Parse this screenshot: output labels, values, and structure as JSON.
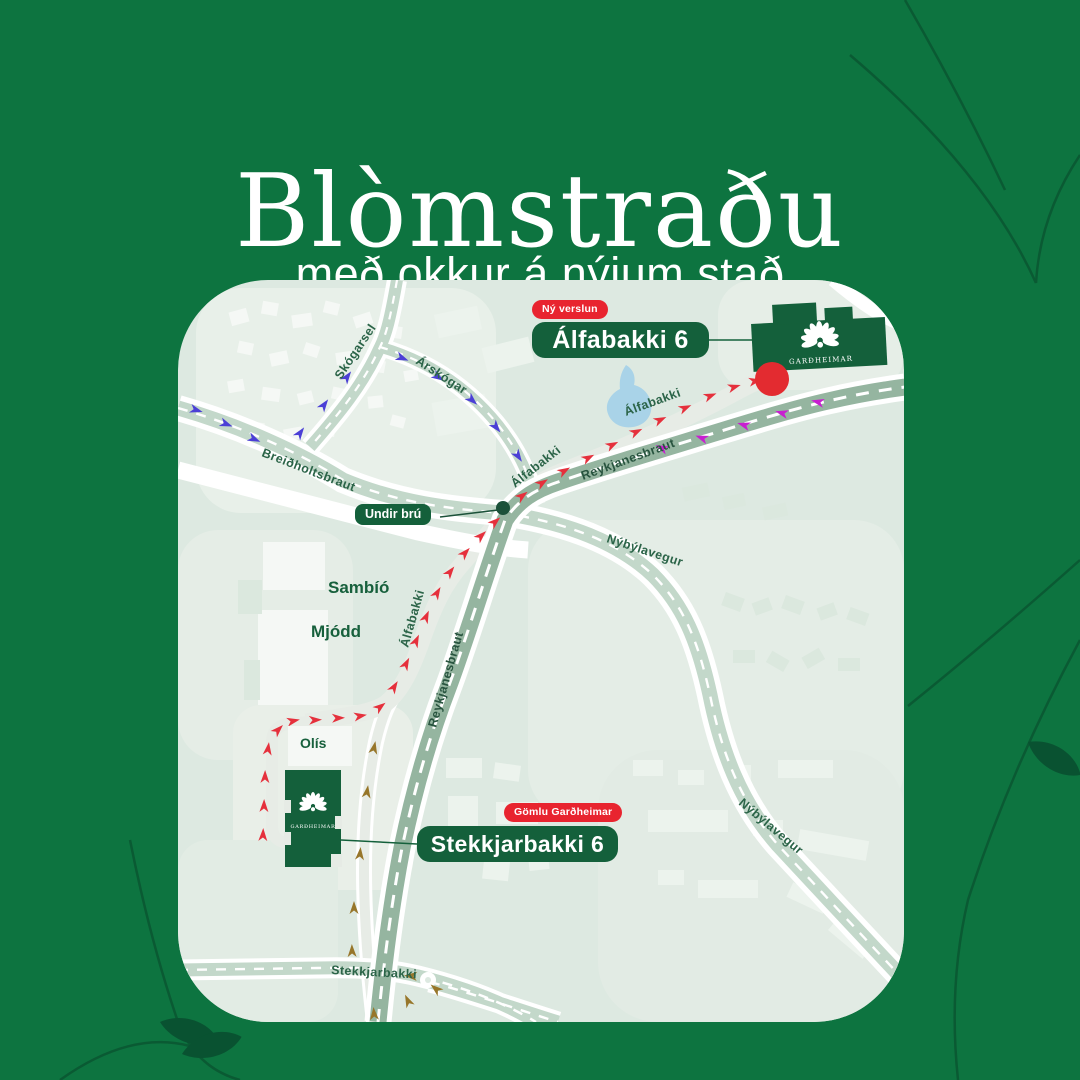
{
  "header": {
    "title": "Blòmstraðu",
    "subtitle": "með okkur á nýjum stað"
  },
  "map": {
    "callouts": {
      "new_store_tag": "Ný verslun",
      "new_store_address": "Álfabakki 6",
      "old_store_tag": "Gömlu Garðheimar",
      "old_store_address": "Stekkjarbakki 6",
      "under_bridge": "Undir brú"
    },
    "roads": {
      "skogarsel": "Skógarsel",
      "arskogar": "Árskógar",
      "breidholtsbraut": "Breiðholtsbraut",
      "alfabakki": "Álfabakki",
      "reykjanesbraut": "Reykjanesbraut",
      "nybylavegur": "Nýbýlavegur",
      "stekkjarbakki": "Stekkjarbakki"
    },
    "places": {
      "cinema": "Sambíó",
      "district": "Mjódd",
      "gas_station": "Olís"
    },
    "brand": "GARÐHEIMAR"
  },
  "colors": {
    "background": "#0d7440",
    "decor_leaf": "#095231",
    "map_base": "#dde9e1",
    "brand_green": "#14603b",
    "badge_red": "#e8242f",
    "marker_red": "#e32b30",
    "route_red": "#e5303c",
    "route_blue": "#4b3fd6",
    "route_magenta": "#c81fd0",
    "route_olive": "#97762a",
    "road_green": "#c3d8ca",
    "highway_green": "#95b5a0",
    "label_green": "#2b6448",
    "water_blue": "#a9d3e8"
  }
}
